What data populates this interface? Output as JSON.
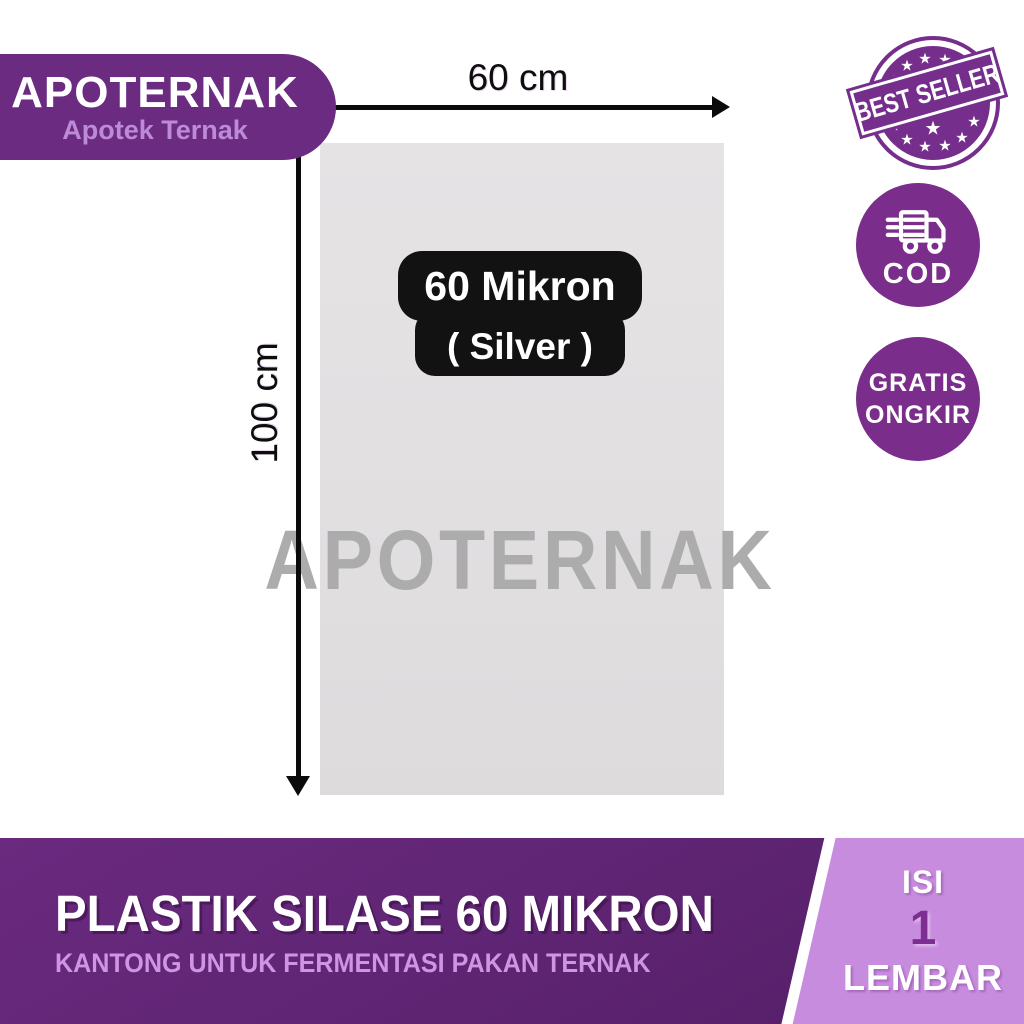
{
  "brand": {
    "name": "APOTERNAK",
    "tagline": "Apotek Ternak",
    "watermark": "APOTERNAK"
  },
  "dimensions": {
    "width_label": "60 cm",
    "height_label": "100 cm"
  },
  "spec_badge": {
    "line1": "60 Mikron",
    "line2": "( Silver )"
  },
  "badges": {
    "best_seller": "BEST SELLER",
    "cod": "COD",
    "free_shipping_line1": "GRATIS",
    "free_shipping_line2": "ONGKIR"
  },
  "banner": {
    "title": "PLASTIK SILASE 60 MIKRON",
    "subtitle": "KANTONG UNTUK FERMENTASI PAKAN TERNAK"
  },
  "quantity": {
    "label_top": "ISI",
    "value": "1",
    "label_bottom": "LEMBAR"
  },
  "colors": {
    "brand_purple": "#6B2B81",
    "stamp_purple": "#752E8C",
    "circle_purple": "#7B2D8C",
    "banner_purple": "#5E2472",
    "panel_purple": "#C88CDF",
    "subtitle_purple": "#CE95E3",
    "value_purple": "#7C2F91",
    "bag_gray": "#E2E0E1",
    "watermark_gray": "#ACACAC",
    "tagline_purple": "#BD8BD6"
  }
}
